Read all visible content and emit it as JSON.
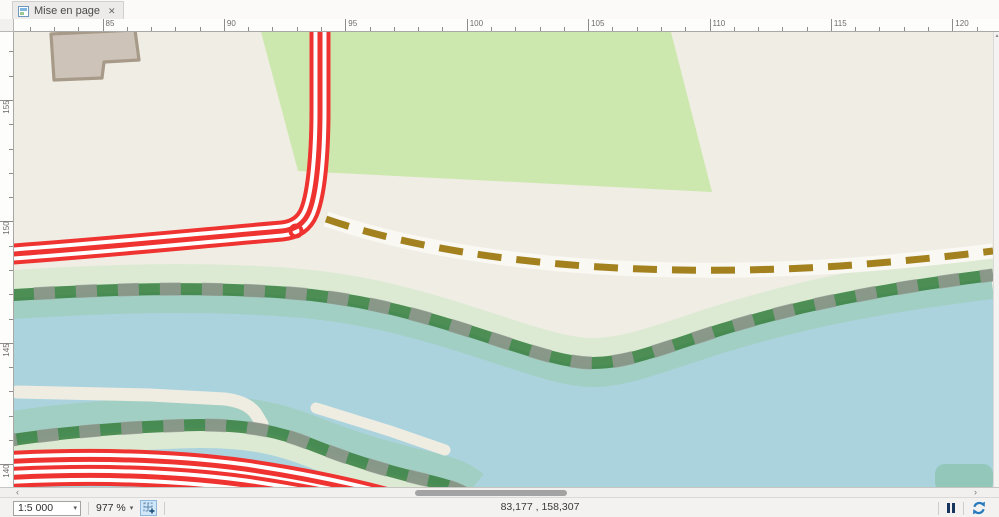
{
  "tab": {
    "title": "Mise en page",
    "close_label": "✕"
  },
  "rulers": {
    "top_labels": [
      "85",
      "90",
      "95",
      "100",
      "105",
      "110",
      "115",
      "120"
    ],
    "left_labels": [
      "155",
      "150",
      "145",
      "140"
    ]
  },
  "scrollbars": {
    "h_left_arrow": "‹",
    "h_right_arrow": "›",
    "v_up_arrow": "▲"
  },
  "statusbar": {
    "scale_value": "1:5 000",
    "scale_caret": "▾",
    "zoom_value": "977 %",
    "zoom_caret": "▾",
    "coordinates": "83,177 , 158,307"
  },
  "palette": {
    "paper": "#f0ede4",
    "grass": "#cde8ae",
    "water": "#aad3de",
    "teal_band": "#a2cfc3",
    "pale_band": "#dcead3",
    "embank_green": "#3f8549",
    "embank_gray": "#989b96",
    "road_red": "#ee3330",
    "road_white": "#ffffff",
    "path_dash": "#a2811e",
    "path_band": "#faf8f2",
    "building_fill": "#cdc3b8",
    "building_stroke": "#a79a89",
    "pier": "#efece1",
    "corner_patch": "#93c7b9",
    "pause_color": "#17365d",
    "accent_blue": "#2879bd"
  }
}
